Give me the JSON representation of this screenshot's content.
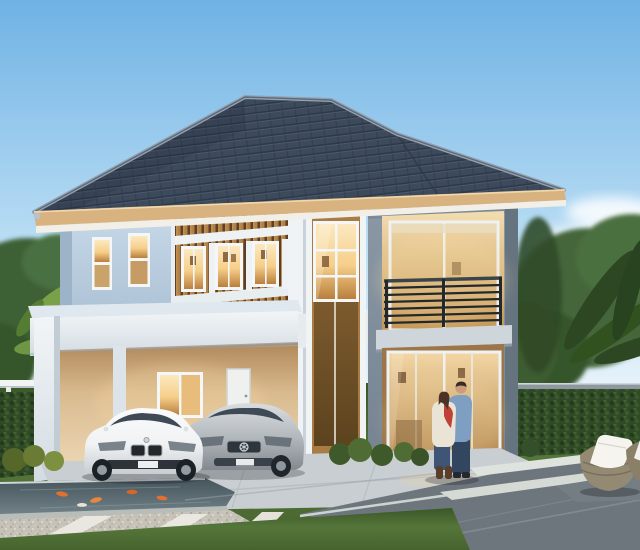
{
  "meta": {
    "title": "Modern two-storey house — exterior 3D rendering at dusk",
    "type": "architectural rendering (photo-like, no text)",
    "width_px": 640,
    "height_px": 550
  },
  "scene": {
    "sky": "clear blue gradient sky, soft white clouds lower right",
    "house": {
      "storeys": 2,
      "roof": "dark blue-grey hipped tile roof with tan fascia and white soffit",
      "features": [
        "timber-slat feature wall with three lit windows on upper floor",
        "double-height glazed column with timber panel below",
        "grey-framed tower with upper balcony and dark horizontal railing",
        "lit sliding glass doors on ground floor",
        "white flat-roof carport with corner columns",
        "lit window and white door inside carport",
        "two small lit windows on the left blue-grey wall"
      ]
    },
    "vehicles": [
      {
        "name": "white sports coupe",
        "position": "carport, left"
      },
      {
        "name": "silver coupe",
        "position": "carport, right"
      }
    ],
    "people": [
      {
        "name": "couple embracing",
        "detail": "man in light-blue shirt and jeans, woman in cream cardigan with red bouquet and brown boots",
        "position": "in front of ground-floor glass doors"
      }
    ],
    "landscape": [
      "trees and banana palms behind white fence (left)",
      "trimmed hedge wall with grey top rail (right)",
      "large tree and dark palm fronds at right edge",
      "koi pond with orange koi (front left)",
      "gravel walkway crossed by white concrete bands",
      "light concrete apron and stepping bands in lawn",
      "dark asphalt driveway with pale joint lines",
      "two rattan bowl chairs with white cushions (front right)",
      "yellow-green shrubs along the house base"
    ]
  },
  "colors": {
    "sky_top": "#6fb2e4",
    "sky_mid": "#b9ddf4",
    "sky_horizon": "#eaf4fb",
    "cloud": "#ffffff",
    "roof_tile": "#3c4a5c",
    "roof_tile_dark": "#2d3947",
    "roof_ridge": "#93a1b0",
    "fascia": "#d9b37f",
    "soffit": "#f1efe8",
    "wall_blue": "#b9cde0",
    "wall_blue_dark": "#9db3c8",
    "beam_white": "#e9eef2",
    "carport_wall": "#e3cda8",
    "slat_wood": "#b28147",
    "slat_gap": "#5d4023",
    "column_tan": "#a87c42",
    "column_panel": "#7c5a2e",
    "window_frame": "#f4f6f7",
    "window_warm": "#f6cf8a",
    "window_deep": "#b97f3c",
    "tower_frame": "#8b99a7",
    "tower_frame_dark": "#66747f",
    "railing": "#23282d",
    "balcony_slab": "#ced6db",
    "grass": "#55763a",
    "grass_dark": "#3a5727",
    "hedge": "#2f4a26",
    "tree_green": "#44663a",
    "palm_dark": "#2c4722",
    "fence_white": "#f2f4f4",
    "pond_water": "#57666d",
    "koi_orange": "#e2702e",
    "gravel": "#c6c2b8",
    "concrete_band": "#e9e7df",
    "apron": "#c9ced2",
    "asphalt": "#6e767d",
    "asphalt_line": "#ccd4d2",
    "car_white": "#f0f2f3",
    "car_silver": "#b4b9be",
    "car_glass": "#3e4a56",
    "wicker": "#948a73",
    "cushion": "#f5f4ef",
    "skin": "#c99d7e",
    "shirt_blue": "#7f9fc2",
    "jeans": "#3a5070",
    "cardigan": "#eae4d6",
    "accent_red": "#bf4136"
  }
}
